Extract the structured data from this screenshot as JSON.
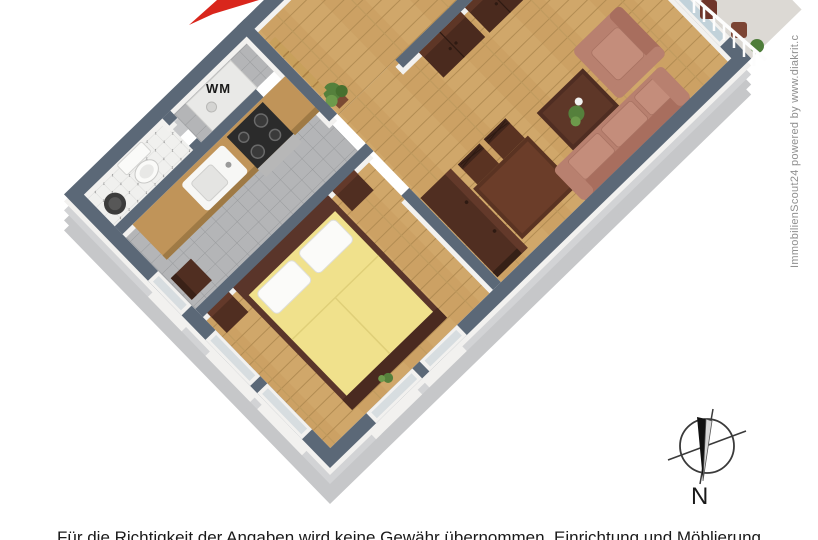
{
  "labels": {
    "wm": "WM",
    "compass_north": "N"
  },
  "watermark": {
    "text": "ImmobilienScout24 powered by www.diakrit.c"
  },
  "disclaimer": {
    "text": "Für die Richtigkeit der Angaben wird keine Gewähr übernommen. Einrichtung und Möblierung"
  },
  "icons": {
    "logo": "red-arrow-logo-icon",
    "compass": "compass-rose-icon"
  },
  "colors": {
    "wall_top": "#5b6877",
    "wall_face": "#f2f1ef",
    "outer_wall": "#c6c7c9",
    "floor_wood": "#cca164",
    "floor_kitchen_tile": "#b4b5b7",
    "floor_bath_tile": "#f0f0ee",
    "bed_blanket": "#f0e18c",
    "sofa": "#b8806f",
    "furniture_wood": "#502e21",
    "kitchen_counter": "#c09459",
    "logo_red": "#d9261c",
    "plant_green": "#55803c",
    "watermark_gray": "#8f8f8f"
  }
}
